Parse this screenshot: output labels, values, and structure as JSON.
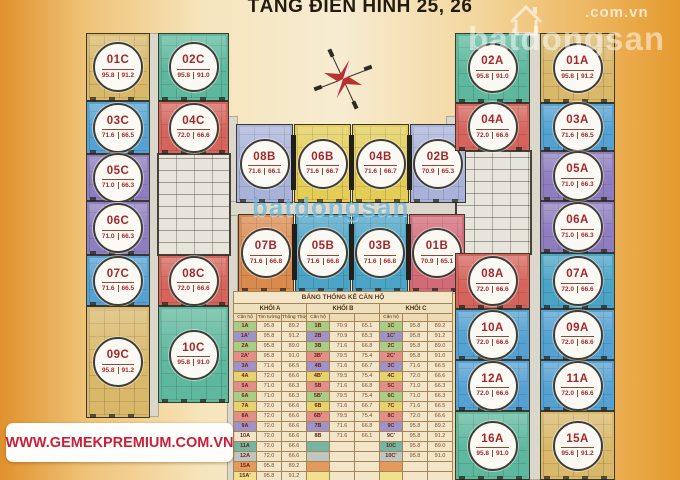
{
  "title": "TẦNG ĐIỂN HÌNH 25, 26",
  "watermark": {
    "brand": "batdongsan",
    "domain": ".com.vn",
    "center_brand": "batdongsan"
  },
  "banner": {
    "url": "WWW.GEMEKPREMIUM.COM.VN"
  },
  "units": [
    {
      "label": "01C",
      "tim": "95.8",
      "thong": "91.2",
      "color": "#d9b869"
    },
    {
      "label": "02C",
      "tim": "95.8",
      "thong": "91.0",
      "color": "#5eb89d"
    },
    {
      "label": "03C",
      "tim": "71.6",
      "thong": "66.5",
      "color": "#55a2d2"
    },
    {
      "label": "04C",
      "tim": "72.0",
      "thong": "66.6",
      "color": "#d5655c"
    },
    {
      "label": "05C",
      "tim": "71.0",
      "thong": "66.3",
      "color": "#8e7ec0"
    },
    {
      "label": "06C",
      "tim": "71.0",
      "thong": "66.3",
      "color": "#8e7ec0"
    },
    {
      "label": "07C",
      "tim": "71.6",
      "thong": "66.5",
      "color": "#55a2d2"
    },
    {
      "label": "08C",
      "tim": "72.0",
      "thong": "66.6",
      "color": "#d5655c"
    },
    {
      "label": "09C",
      "tim": "95.8",
      "thong": "91.2",
      "color": "#d9b869"
    },
    {
      "label": "10C",
      "tim": "95.8",
      "thong": "91.0",
      "color": "#5eb89d"
    },
    {
      "label": "08B",
      "tim": "71.6",
      "thong": "66.1",
      "color": "#a9b3da"
    },
    {
      "label": "06B",
      "tim": "71.6",
      "thong": "66.7",
      "color": "#e3cd57"
    },
    {
      "label": "04B",
      "tim": "71.6",
      "thong": "66.7",
      "color": "#e3cd57"
    },
    {
      "label": "02B",
      "tim": "70.9",
      "thong": "65.3",
      "color": "#a9b3da"
    },
    {
      "label": "07B",
      "tim": "71.6",
      "thong": "66.8",
      "color": "#db8a4d"
    },
    {
      "label": "05B",
      "tim": "71.6",
      "thong": "66.8",
      "color": "#4ba4c6"
    },
    {
      "label": "03B",
      "tim": "71.6",
      "thong": "66.8",
      "color": "#4ba4c6"
    },
    {
      "label": "01B",
      "tim": "70.9",
      "thong": "65.1",
      "color": "#d26a78"
    },
    {
      "label": "02A",
      "tim": "95.8",
      "thong": "91.0",
      "color": "#5eb89d"
    },
    {
      "label": "01A",
      "tim": "95.8",
      "thong": "91.2",
      "color": "#d9b869"
    },
    {
      "label": "04A",
      "tim": "72.0",
      "thong": "66.6",
      "color": "#d5655c"
    },
    {
      "label": "03A",
      "tim": "71.6",
      "thong": "66.5",
      "color": "#55a2d2"
    },
    {
      "label": "05A",
      "tim": "71.0",
      "thong": "66.3",
      "color": "#8e7ec0"
    },
    {
      "label": "06A",
      "tim": "71.0",
      "thong": "66.3",
      "color": "#8e7ec0"
    },
    {
      "label": "08A",
      "tim": "72.0",
      "thong": "66.6",
      "color": "#d5655c"
    },
    {
      "label": "07A",
      "tim": "72.0",
      "thong": "66.6",
      "color": "#4ba4c6"
    },
    {
      "label": "10A",
      "tim": "72.0",
      "thong": "66.6",
      "color": "#55a2d2"
    },
    {
      "label": "09A",
      "tim": "72.0",
      "thong": "66.6",
      "color": "#55a2d2"
    },
    {
      "label": "12A",
      "tim": "72.0",
      "thong": "66.6",
      "color": "#55a2d2"
    },
    {
      "label": "11A",
      "tim": "72.0",
      "thong": "66.6",
      "color": "#55a2d2"
    },
    {
      "label": "16A",
      "tim": "95.8",
      "thong": "91.0",
      "color": "#5eb89d"
    },
    {
      "label": "15A",
      "tim": "95.8",
      "thong": "91.2",
      "color": "#d9b869"
    }
  ],
  "table": {
    "title": "BẢNG THỐNG KÊ CĂN HỘ",
    "blocks": [
      "KHỐI A",
      "KHỐI B",
      "KHỐI C"
    ],
    "columns": [
      "Căn hộ",
      "Tim tường",
      "Thông Thủy",
      "Căn hộ",
      "",
      "",
      "Căn hộ",
      "",
      ""
    ],
    "rows": [
      {
        "color": "#a9cd84",
        "cells": [
          "1A",
          "95.8",
          "89.2",
          "1B",
          "70.9",
          "65.1",
          "1C",
          "95.8",
          "89.2"
        ]
      },
      {
        "color": "#9e92c6",
        "cells": [
          "1A'",
          "95.8",
          "91.2",
          "2B",
          "70.9",
          "65.3",
          "1C'",
          "95.8",
          "91.2"
        ]
      },
      {
        "color": "#a9cd84",
        "cells": [
          "2A",
          "95.8",
          "89.0",
          "3B",
          "71.6",
          "66.8",
          "2C",
          "95.8",
          "89.0"
        ]
      },
      {
        "color": "#e28f8a",
        "cells": [
          "2A'",
          "95.8",
          "91.0",
          "3B'",
          "79.5",
          "75.4",
          "2C'",
          "95.8",
          "91.0"
        ]
      },
      {
        "color": "#9e92c6",
        "cells": [
          "3A",
          "71.6",
          "66.5",
          "4B",
          "71.6",
          "66.7",
          "3C",
          "71.6",
          "66.5"
        ]
      },
      {
        "color": "#e6d36b",
        "cells": [
          "4A",
          "72.0",
          "66.6",
          "4B'",
          "79.5",
          "75.4",
          "4C",
          "72.0",
          "66.6"
        ]
      },
      {
        "color": "#e28f8a",
        "cells": [
          "5A",
          "71.0",
          "66.3",
          "5B",
          "71.6",
          "66.8",
          "5C",
          "71.0",
          "66.3"
        ]
      },
      {
        "color": "#a9cd84",
        "cells": [
          "6A",
          "71.0",
          "66.3",
          "5B'",
          "79.5",
          "75.4",
          "6C",
          "71.0",
          "66.3"
        ]
      },
      {
        "color": "#e6d36b",
        "cells": [
          "7A",
          "72.0",
          "66.6",
          "6B",
          "71.6",
          "66.7",
          "7C",
          "71.6",
          "66.5"
        ]
      },
      {
        "color": "#e28f8a",
        "cells": [
          "8A",
          "72.0",
          "66.6",
          "6B'",
          "79.5",
          "75.4",
          "8C",
          "72.0",
          "66.6"
        ]
      },
      {
        "color": "#9e92c6",
        "cells": [
          "9A",
          "72.0",
          "66.6",
          "7B",
          "71.6",
          "66.8",
          "9C",
          "95.8",
          "89.2"
        ]
      },
      {
        "color": "#f1e7cd",
        "cells": [
          "10A",
          "72.0",
          "66.6",
          "8B",
          "71.6",
          "66.1",
          "9C'",
          "95.8",
          "91.2"
        ]
      },
      {
        "color": "#74b5a4",
        "cells": [
          "11A",
          "72.0",
          "66.6",
          "",
          "",
          "",
          "10C",
          "95.8",
          "89.0"
        ]
      },
      {
        "color": "#bfc6bd",
        "cells": [
          "12A",
          "72.0",
          "66.6",
          "",
          "",
          "",
          "10C'",
          "95.8",
          "91.0"
        ]
      },
      {
        "color": "#e59a5d",
        "cells": [
          "15A",
          "95.8",
          "89.2",
          "",
          "",
          "",
          "",
          "",
          ""
        ]
      },
      {
        "color": "#efe18d",
        "cells": [
          "15A'",
          "95.8",
          "91.2",
          "",
          "",
          "",
          "",
          "",
          ""
        ]
      },
      {
        "color": "#cfae6f",
        "cells": [
          "16A",
          "95.8",
          "89.0",
          "",
          "",
          "",
          "",
          "",
          ""
        ]
      },
      {
        "color": "#a8764a",
        "cells": [
          "16A'",
          "95.8",
          "91.0",
          "",
          "",
          "",
          "",
          "",
          ""
        ]
      }
    ]
  }
}
